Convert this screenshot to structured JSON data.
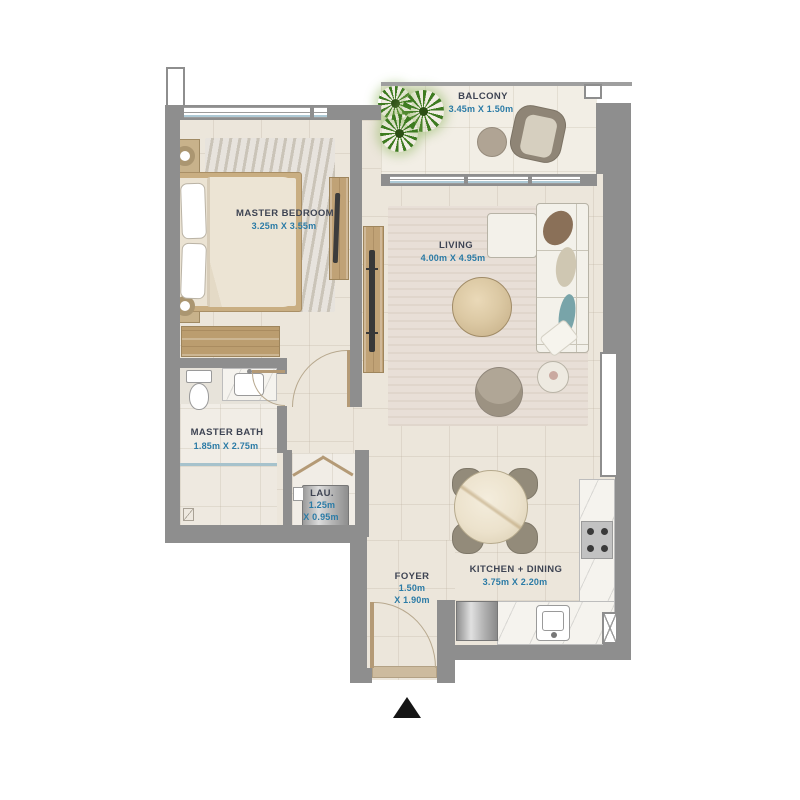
{
  "rooms": {
    "balcony": {
      "name": "BALCONY",
      "dims": "3.45m X 1.50m"
    },
    "master_bedroom": {
      "name": "MASTER BEDROOM",
      "dims": "3.25m X 3.55m"
    },
    "living": {
      "name": "LIVING",
      "dims": "4.00m X 4.95m"
    },
    "master_bath": {
      "name": "MASTER BATH",
      "dims": "1.85m X 2.75m"
    },
    "laundry": {
      "name": "LAU.",
      "dims_l1": "1.25m",
      "dims_l2": "X 0.95m"
    },
    "foyer": {
      "name": "FOYER",
      "dims_l1": "1.50m",
      "dims_l2": "X 1.90m"
    },
    "kitchen_dining": {
      "name": "KITCHEN + DINING",
      "dims": "3.75m X 2.20m"
    }
  },
  "icons": {
    "entrance_marker": "triangle-up"
  },
  "colors": {
    "wall": "#8e8e8e",
    "floor": "#ece6db",
    "room_text": "#3e4453",
    "dims_text": "#2b7ba6",
    "wood": "#c0a276",
    "plant": "#3e7b21"
  }
}
